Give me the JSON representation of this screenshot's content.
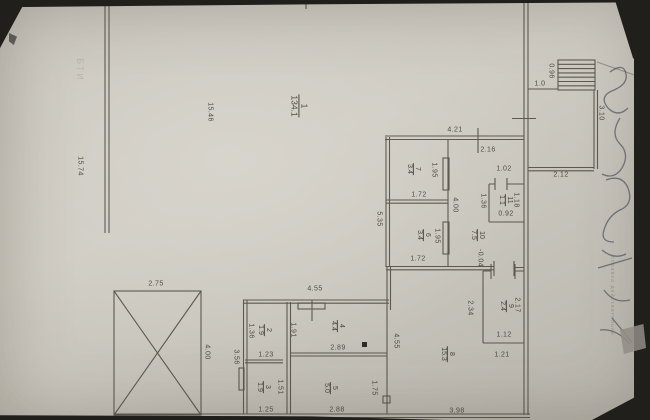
{
  "document_type": "floor-plan photo",
  "colors": {
    "paper": "#cbc8c0",
    "line": "#4a463e",
    "background": "#211f1b",
    "ink": "#4b5160"
  },
  "labels": {
    "rooms": [
      {
        "num": "1",
        "den": "134.1",
        "x": 299,
        "y": 106,
        "big": true
      },
      {
        "num": "7",
        "den": "3.4",
        "x": 413,
        "y": 169
      },
      {
        "num": "6",
        "den": "3.4",
        "x": 423,
        "y": 235
      },
      {
        "num": "11",
        "den": "1.1",
        "x": 505,
        "y": 200
      },
      {
        "num": "10",
        "den": "7.5",
        "x": 477,
        "y": 235
      },
      {
        "num": "9",
        "den": "2.4",
        "x": 506,
        "y": 306
      },
      {
        "num": "8",
        "den": "15.3",
        "x": 447,
        "y": 354
      },
      {
        "num": "2",
        "den": "1.9",
        "x": 264,
        "y": 330
      },
      {
        "num": "3",
        "den": "1.9",
        "x": 263,
        "y": 387
      },
      {
        "num": "4",
        "den": "4.4",
        "x": 337,
        "y": 326
      },
      {
        "num": "5",
        "den": "5.0",
        "x": 330,
        "y": 388
      }
    ],
    "dims_v": [
      {
        "t": "15.74",
        "x": 80,
        "y": 166
      },
      {
        "t": "15.46",
        "x": 210,
        "y": 112
      },
      {
        "t": "0.96",
        "x": 551,
        "y": 71
      },
      {
        "t": "3.10",
        "x": 601,
        "y": 113
      },
      {
        "t": "5.35",
        "x": 379,
        "y": 219
      },
      {
        "t": "1.95",
        "x": 434,
        "y": 170
      },
      {
        "t": "4.00",
        "x": 455,
        "y": 205
      },
      {
        "t": "1.95",
        "x": 437,
        "y": 236
      },
      {
        "t": "1.36",
        "x": 483,
        "y": 201
      },
      {
        "t": "1.18",
        "x": 516,
        "y": 200
      },
      {
        "t": "2.17",
        "x": 517,
        "y": 305
      },
      {
        "t": "2.34",
        "x": 470,
        "y": 308
      },
      {
        "t": "4.55",
        "x": 396,
        "y": 341
      },
      {
        "t": "1.75",
        "x": 374,
        "y": 388
      },
      {
        "t": "1.91",
        "x": 293,
        "y": 330
      },
      {
        "t": "1.36",
        "x": 251,
        "y": 331
      },
      {
        "t": "1.51",
        "x": 280,
        "y": 387
      },
      {
        "t": "3.56",
        "x": 236,
        "y": 357
      },
      {
        "t": "4.00",
        "x": 207,
        "y": 352
      },
      {
        "t": "-0.04",
        "x": 480,
        "y": 258
      }
    ],
    "dims_h": [
      {
        "t": "4.21",
        "x": 455,
        "y": 130
      },
      {
        "t": "2.16",
        "x": 488,
        "y": 150
      },
      {
        "t": "1.0",
        "x": 540,
        "y": 84
      },
      {
        "t": "2.12",
        "x": 561,
        "y": 175
      },
      {
        "t": "1.02",
        "x": 504,
        "y": 169
      },
      {
        "t": "0.92",
        "x": 506,
        "y": 214
      },
      {
        "t": "1.72",
        "x": 419,
        "y": 195
      },
      {
        "t": "1.72",
        "x": 418,
        "y": 259
      },
      {
        "t": "4.55",
        "x": 315,
        "y": 289
      },
      {
        "t": "2.75",
        "x": 156,
        "y": 284
      },
      {
        "t": "1.23",
        "x": 266,
        "y": 355
      },
      {
        "t": "2.89",
        "x": 338,
        "y": 348
      },
      {
        "t": "1.25",
        "x": 266,
        "y": 410
      },
      {
        "t": "2.88",
        "x": 337,
        "y": 410
      },
      {
        "t": "1.12",
        "x": 504,
        "y": 335
      },
      {
        "t": "1.21",
        "x": 502,
        "y": 355
      },
      {
        "t": "3.98",
        "x": 457,
        "y": 411
      }
    ]
  },
  "stamps": {
    "top_left": "БТИ",
    "right_margin": "инвентаризационное бюро технического учета",
    "right_note": "справка действительна"
  }
}
